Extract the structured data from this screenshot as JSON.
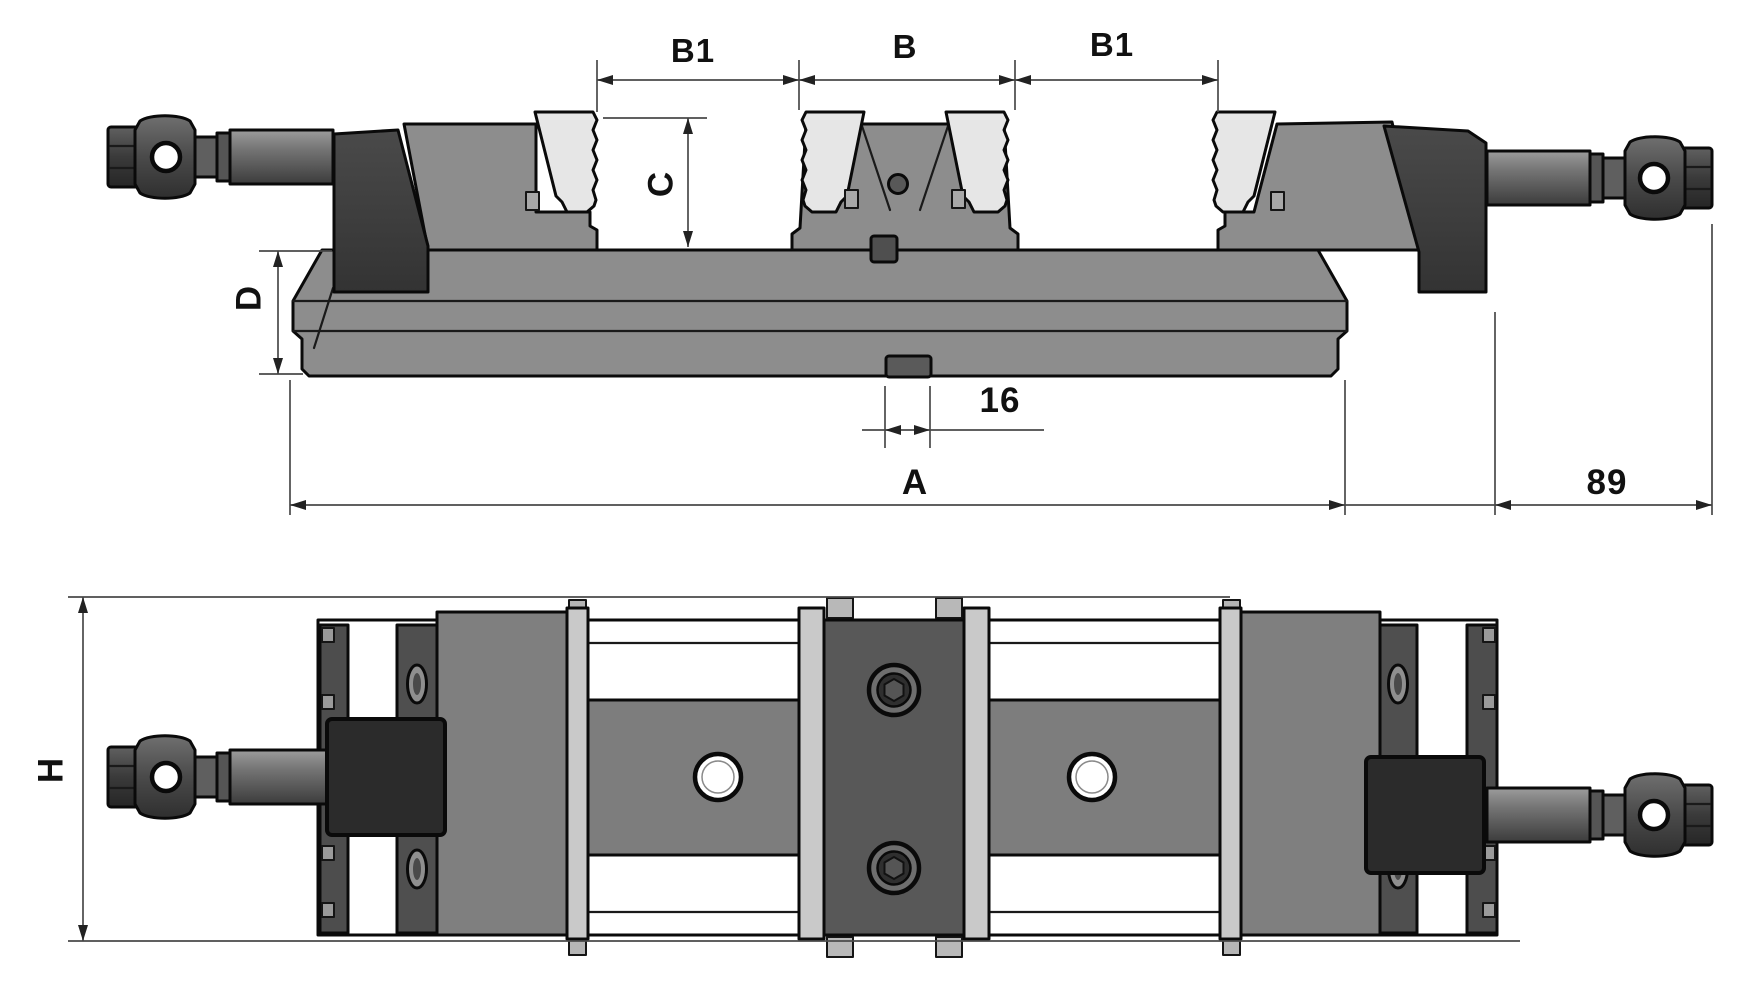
{
  "document": {
    "type": "technical-drawing",
    "subject": "Double-station machine vise, two orthographic views (front elevation and top plan)"
  },
  "front_view": {
    "dims": {
      "b1_left": "B1",
      "b_center": "B",
      "b1_right": "B1",
      "jaw_depth": "C",
      "base_height": "D",
      "key_width": "16",
      "body_length": "A",
      "screw_overhang": "89"
    }
  },
  "plan_view": {
    "dims": {
      "overall_width": "H"
    }
  },
  "colors": {
    "background": "#ffffff",
    "body_gray": "#8d8d8d",
    "dark_block": "#3f3f3f",
    "end_plate": "#4d4d4d",
    "bracket": "#4f4f4f",
    "jaw_block": "#7f7f7f",
    "center_block": "#585858",
    "rail": "#7d7d7d",
    "nut_block": "#2b2b2b",
    "insert_light": "#e6e6e6",
    "strip_light": "#c9c9c9",
    "key_gray": "#5a5a5a",
    "outline": "#0a0a0a",
    "dim_line": "#4a4a4a",
    "dim_text": "#111111"
  }
}
